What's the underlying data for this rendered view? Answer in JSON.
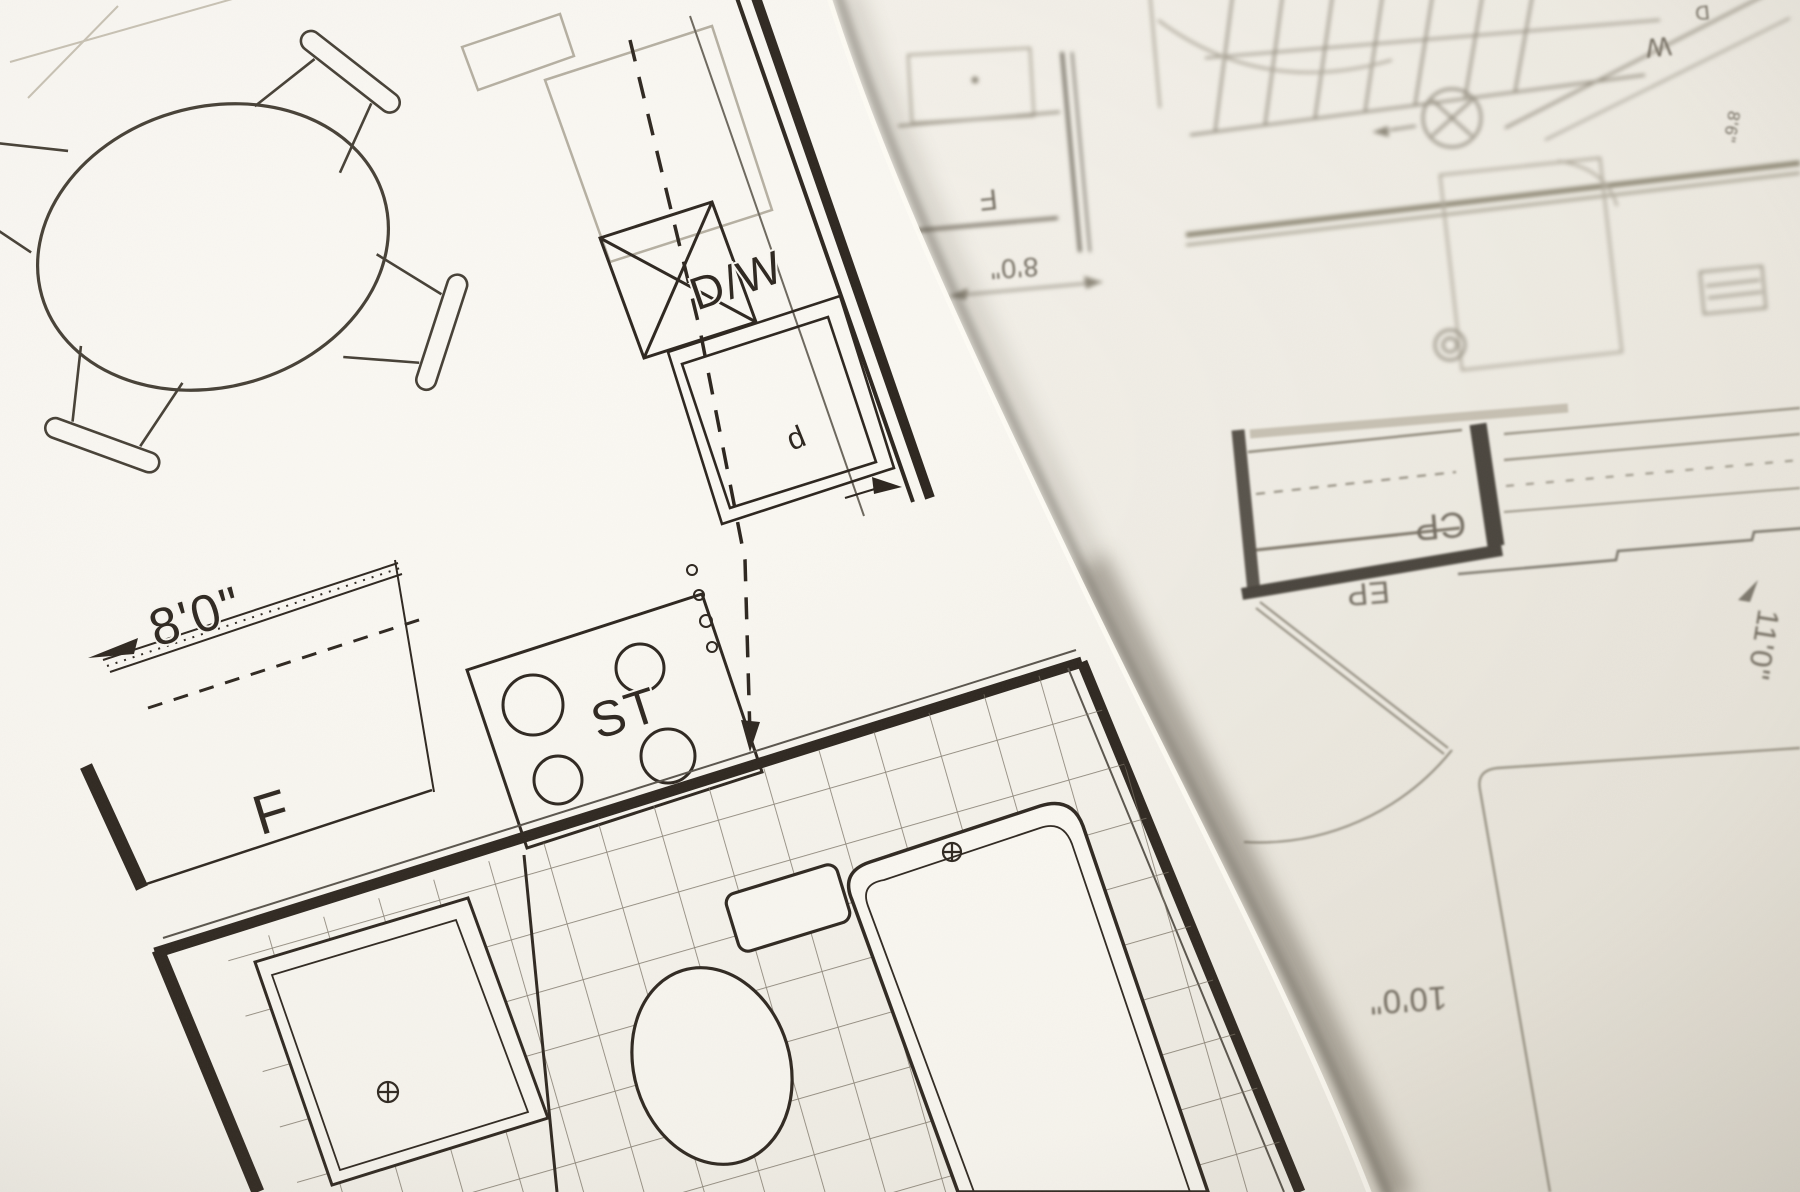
{
  "scene": {
    "type": "photograph",
    "subject": "Two overlapping architectural floor-plan sheets, top sheet tilted and casting a shadow on an upside-down sheet beneath",
    "colors": {
      "paper_top": "#fbf9f4",
      "paper_under": "#f1eee6",
      "ink_top": "#2b241d",
      "ink_under": "#8d8779",
      "shadow": "#5e5749"
    }
  },
  "top_sheet": {
    "description": "kitchen and bathroom plan, in focus, rotated counter-clockwise",
    "labels": {
      "dishwasher": "D/W",
      "stove": "ST",
      "refrigerator": "F",
      "sink_cabinet": "d",
      "counter_dim": "8'0\""
    }
  },
  "under_sheet": {
    "description": "bedroom / stair plan, out of focus, rotated 180 degrees (text upside down)",
    "labels": {
      "dryer": "D",
      "washer": "W",
      "stair_dim": "8'6\"",
      "room_f": "F",
      "room_dim": "8'0\"",
      "closet_cp": "CP",
      "closet_ep": "EP",
      "wall_dim_11": "11'0\"",
      "room_dim_10": "10'0\""
    }
  }
}
